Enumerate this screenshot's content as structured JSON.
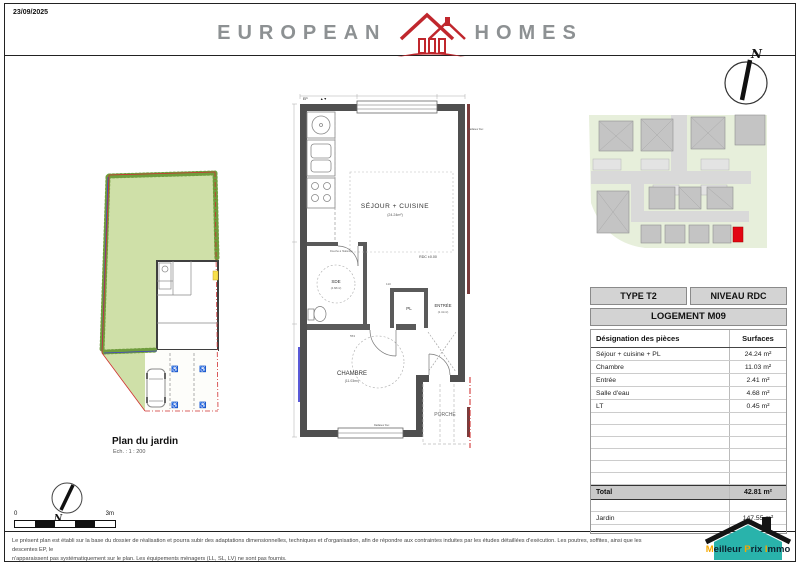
{
  "page": {
    "date": "23/09/2025"
  },
  "brand": {
    "name_left": "EUROPEAN",
    "name_right": "HOMES",
    "accent": "#c0272d",
    "gray": "#8d9193"
  },
  "compass": {
    "north": "N"
  },
  "compass_small": {
    "north": "N"
  },
  "garden": {
    "title": "Plan du jardin",
    "scale": "Ech. : 1 : 200"
  },
  "floorplan": {
    "ep": "EP",
    "markers": "▲▼",
    "living_label": "SÉJOUR + CUISINE",
    "living_area": "(24.24m²)",
    "level": "RDC ±0.00",
    "sde_label": "SDE",
    "sde_area": "(4.68m²)",
    "shower_note": "Douche à l'italienne",
    "pl_label": "PL",
    "entry_label": "ENTRÉE",
    "entry_area": "(2.41m²)",
    "bedroom_label": "CHAMBRE",
    "bedroom_area": "(11.03m²)",
    "porch_label": "PORCHE",
    "radiator_top": "Radiateur Dec",
    "radiator_bottom": "Radiateur Dec",
    "dim_a": "553",
    "dim_b": "110"
  },
  "scalebar": {
    "start": "0",
    "end": "3m"
  },
  "table": {
    "type": "TYPE T2",
    "level": "NIVEAU RDC",
    "unit": "LOGEMENT M09",
    "col_rooms": "Désignation des pièces",
    "col_surfaces": "Surfaces",
    "rows": [
      {
        "label": "Séjour + cuisine + PL",
        "value": "24.24 m²"
      },
      {
        "label": "Chambre",
        "value": "11.03 m²"
      },
      {
        "label": "Entrée",
        "value": "2.41 m²"
      },
      {
        "label": "Salle d'eau",
        "value": "4.68 m²"
      },
      {
        "label": "LT",
        "value": "0.45 m²"
      }
    ],
    "total_label": "Total",
    "total_value": "42.81 m²",
    "garden_label": "Jardin",
    "garden_value": "147.55 m²"
  },
  "footer": {
    "line1": "Le présent plan est établi sur la base du dossier de réalisation et pourra subir des adaptations dimensionnelles, techniques et d'organisation, afin de répondre aux contraintes induites par les études détaillées d'exécution. Les poutres, soffites, ainsi que les descentes EP, le",
    "line2": "n'apparaissent pas systématiquement sur le plan. Les équipements ménagers (LL, SL, LV) ne sont pas fournis."
  },
  "mpi": {
    "m1": "M",
    "m2": "eilleur ",
    "p1": "P",
    "p2": "rix ",
    "i1": "I",
    "i2": "mmo"
  }
}
